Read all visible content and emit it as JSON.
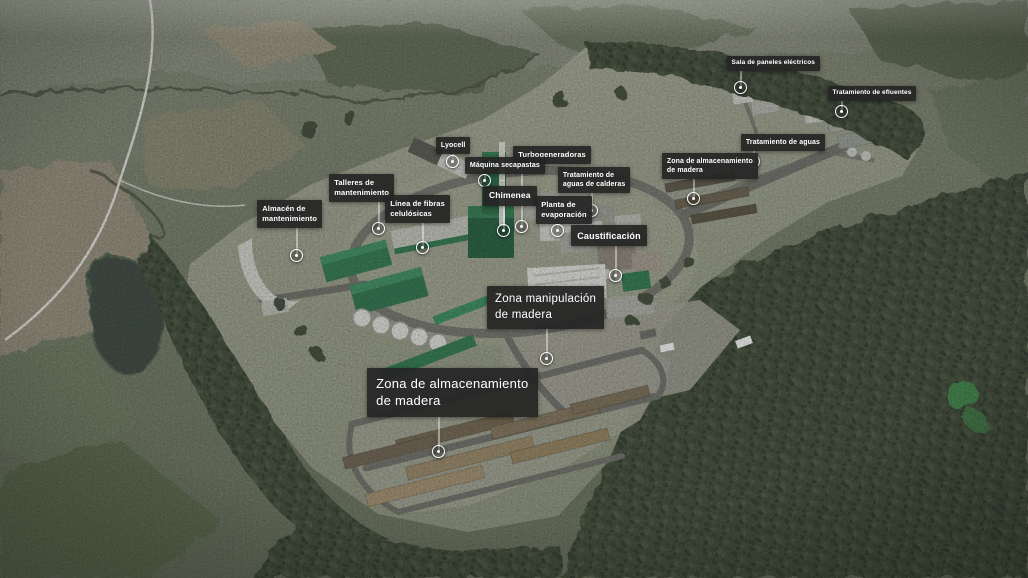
{
  "colors": {
    "label_bg": "#252525",
    "label_text": "#ffffff",
    "marker_ring": "#ffffff",
    "terrain_base": "#76806b",
    "forest_dark": "#3c4836",
    "platform_cleared": "#9da390",
    "road_gray": "#70706a",
    "plant_green": "#2c7a4e",
    "wood_pile_tan": "#9b8a67",
    "water_dark": "#39453c"
  },
  "labels": [
    {
      "id": "sala-paneles-electricos",
      "text": "Sala de paneles eléctricos",
      "lines": [
        "Sala de paneles eléctricos"
      ],
      "box": {
        "x": 727,
        "y": 56,
        "fs": 6.5
      },
      "marker": {
        "x": 741,
        "y": 88
      }
    },
    {
      "id": "tratamiento-efluentes",
      "text": "Tratamiento de efluentes",
      "lines": [
        "Tratamiento de efluentes"
      ],
      "box": {
        "x": 828,
        "y": 86,
        "fs": 6.5
      },
      "marker": {
        "x": 842,
        "y": 112
      }
    },
    {
      "id": "tratamiento-aguas",
      "text": "Tratamiento de aguas",
      "lines": [
        "Tratamiento de aguas"
      ],
      "box": {
        "x": 741,
        "y": 134,
        "fs": 7
      },
      "marker": {
        "x": 754,
        "y": 162
      }
    },
    {
      "id": "zona-almacenamiento-madera-ne",
      "text": "Zona de almacenamiento de madera",
      "lines": [
        "Zona de almacenamiento",
        "de madera"
      ],
      "box": {
        "x": 662,
        "y": 153,
        "fs": 7
      },
      "marker": {
        "x": 694,
        "y": 199
      }
    },
    {
      "id": "lyocell",
      "text": "Lyocell",
      "lines": [
        "Lyocell"
      ],
      "box": {
        "x": 436,
        "y": 137,
        "fs": 7
      },
      "marker": {
        "x": 453,
        "y": 162
      }
    },
    {
      "id": "turbogeneradoras",
      "text": "Turbogeneradoras",
      "lines": [
        "Turbogeneradoras"
      ],
      "box": {
        "x": 513,
        "y": 146,
        "fs": 7.5
      },
      "marker": {
        "x": 522,
        "y": 227
      }
    },
    {
      "id": "maquina-secapastas",
      "text": "Máquina secapastas",
      "lines": [
        "Máquina secapastas"
      ],
      "box": {
        "x": 465,
        "y": 157,
        "fs": 7
      },
      "marker": {
        "x": 485,
        "y": 181
      }
    },
    {
      "id": "tratamiento-aguas-calderas",
      "text": "Tratamiento de aguas de calderas",
      "lines": [
        "Tratamiento de",
        "aguas de calderas"
      ],
      "box": {
        "x": 558,
        "y": 167,
        "fs": 7
      },
      "marker": {
        "x": 592,
        "y": 211
      }
    },
    {
      "id": "chimenea",
      "text": "Chimenea",
      "lines": [
        "Chimenea"
      ],
      "box": {
        "x": 483,
        "y": 186,
        "fs": 8.5
      },
      "marker": {
        "x": 504,
        "y": 231
      }
    },
    {
      "id": "planta-evaporacion",
      "text": "Planta de evaporación",
      "lines": [
        "Planta de",
        "evaporación"
      ],
      "box": {
        "x": 536,
        "y": 196,
        "fs": 7.5
      },
      "marker": {
        "x": 558,
        "y": 231
      }
    },
    {
      "id": "caustificacion",
      "text": "Caustificación",
      "lines": [
        "Caustificación"
      ],
      "box": {
        "x": 571,
        "y": 225,
        "fs": 9
      },
      "marker": {
        "x": 616,
        "y": 276
      }
    },
    {
      "id": "zona-manipulacion-madera",
      "text": "Zona manipulación de madera",
      "lines": [
        "Zona manipulación",
        "de madera"
      ],
      "box": {
        "x": 487,
        "y": 286,
        "fs": 11.5
      },
      "marker": {
        "x": 547,
        "y": 359
      }
    },
    {
      "id": "zona-almacenamiento-madera-sw",
      "text": "Zona de almacenamiento de madera",
      "lines": [
        "Zona de almacenamiento",
        "de madera"
      ],
      "box": {
        "x": 367,
        "y": 368,
        "fs": 13
      },
      "marker": {
        "x": 439,
        "y": 452
      }
    },
    {
      "id": "talleres-mantenimiento",
      "text": "Talleres de mantenimiento",
      "lines": [
        "Talleres de",
        "mantenimiento"
      ],
      "box": {
        "x": 329,
        "y": 174,
        "fs": 7.5
      },
      "marker": {
        "x": 379,
        "y": 229
      }
    },
    {
      "id": "almacen-mantenimiento",
      "text": "Almacén de mantenimiento",
      "lines": [
        "Almacén de",
        "mantenimiento"
      ],
      "box": {
        "x": 257,
        "y": 200,
        "fs": 7.5
      },
      "marker": {
        "x": 297,
        "y": 256
      }
    },
    {
      "id": "linea-fibras-celulosicas",
      "text": "Línea de fibras celulósicas",
      "lines": [
        "Línea de fibras",
        "celulósicas"
      ],
      "box": {
        "x": 385,
        "y": 195,
        "fs": 7.5
      },
      "marker": {
        "x": 423,
        "y": 248
      }
    }
  ]
}
